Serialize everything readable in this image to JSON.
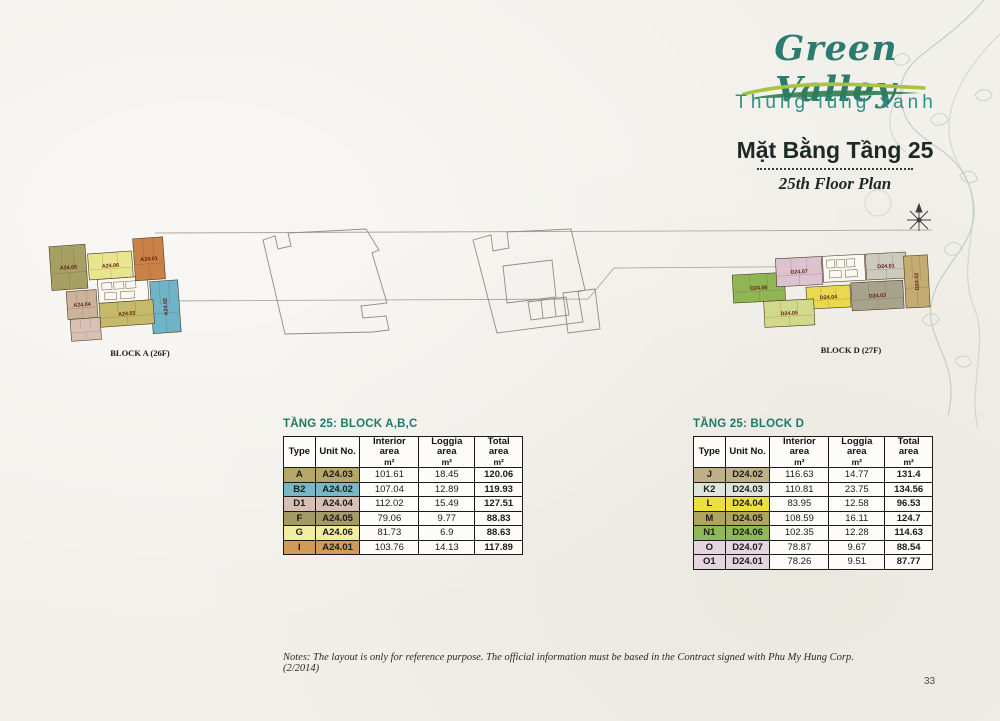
{
  "page": {
    "number": "33"
  },
  "header": {
    "logo_text": "Green Valley",
    "tagline": "Thung lũng xanh",
    "title_vi": "Mặt Bằng Tầng 25",
    "title_en": "25th Floor Plan"
  },
  "site_plan": {
    "block_a_label": "BLOCK A (26F)",
    "block_d_label": "BLOCK D (27F)",
    "block_a_units": [
      {
        "id": "A24.05",
        "color": "#a7a065"
      },
      {
        "id": "A24.06",
        "color": "#e9e48e"
      },
      {
        "id": "A24.01",
        "color": "#c98146"
      },
      {
        "id": "A24.04",
        "color": "#cbb49a"
      },
      {
        "id": "A24.02",
        "color": "#6fb4c8"
      },
      {
        "id": "A24.03",
        "color": "#c5b96a"
      },
      {
        "id": "",
        "color": "#d8c0b4"
      }
    ],
    "block_d_units": [
      {
        "id": "D24.06",
        "color": "#8fb554"
      },
      {
        "id": "D24.07",
        "color": "#dcc3cf"
      },
      {
        "id": "D24.01",
        "color": "#ccc9bd"
      },
      {
        "id": "D24.02",
        "color": "#c3ab72"
      },
      {
        "id": "D24.04",
        "color": "#ead94e"
      },
      {
        "id": "D24.03",
        "color": "#a8a48c"
      },
      {
        "id": "D24.05",
        "color": "#d3d98a"
      }
    ]
  },
  "tables": [
    {
      "title": "TẦNG 25: BLOCK A,B,C",
      "headers": [
        {
          "label": "Type"
        },
        {
          "label": "Unit No."
        },
        {
          "label": "Interior area",
          "unit": "m²"
        },
        {
          "label": "Loggia area",
          "unit": "m²"
        },
        {
          "label": "Total area",
          "unit": "m²"
        }
      ],
      "rows": [
        {
          "type": "A",
          "color": "#b5a76a",
          "unit": "A24.03",
          "interior": "101.61",
          "loggia": "18.45",
          "total": "120.06"
        },
        {
          "type": "B2",
          "color": "#79b7c6",
          "unit": "A24.02",
          "interior": "107.04",
          "loggia": "12.89",
          "total": "119.93"
        },
        {
          "type": "D1",
          "color": "#d7bfb3",
          "unit": "A24.04",
          "interior": "112.02",
          "loggia": "15.49",
          "total": "127.51"
        },
        {
          "type": "F",
          "color": "#a49a66",
          "unit": "A24.05",
          "interior": "79.06",
          "loggia": "9.77",
          "total": "88.83"
        },
        {
          "type": "G",
          "color": "#f2eda0",
          "unit": "A24.06",
          "interior": "81.73",
          "loggia": "6.9",
          "total": "88.63"
        },
        {
          "type": "I",
          "color": "#d09a58",
          "unit": "A24.01",
          "interior": "103.76",
          "loggia": "14.13",
          "total": "117.89"
        }
      ]
    },
    {
      "title": "TẦNG 25: BLOCK D",
      "headers": [
        {
          "label": "Type"
        },
        {
          "label": "Unit No."
        },
        {
          "label": "Interior area",
          "unit": "m²"
        },
        {
          "label": "Loggia area",
          "unit": "m²"
        },
        {
          "label": "Total area",
          "unit": "m²"
        }
      ],
      "rows": [
        {
          "type": "J",
          "color": "#c0b087",
          "unit": "D24.02",
          "interior": "116.63",
          "loggia": "14.77",
          "total": "131.4"
        },
        {
          "type": "K2",
          "color": "#dfe5dc",
          "unit": "D24.03",
          "interior": "110.81",
          "loggia": "23.75",
          "total": "134.56"
        },
        {
          "type": "L",
          "color": "#ecdf3e",
          "unit": "D24.04",
          "interior": "83.95",
          "loggia": "12.58",
          "total": "96.53"
        },
        {
          "type": "M",
          "color": "#b0a55e",
          "unit": "D24.05",
          "interior": "108.59",
          "loggia": "16.11",
          "total": "124.7"
        },
        {
          "type": "N1",
          "color": "#8eb958",
          "unit": "D24.06",
          "interior": "102.35",
          "loggia": "12.28",
          "total": "114.63"
        },
        {
          "type": "O",
          "color": "#e5d5de",
          "unit": "D24.07",
          "interior": "78.87",
          "loggia": "9.67",
          "total": "88.54"
        },
        {
          "type": "O1",
          "color": "#e5d5de",
          "unit": "D24.01",
          "interior": "78.26",
          "loggia": "9.51",
          "total": "87.77"
        }
      ]
    }
  ],
  "note": "Notes: The layout is only for reference purpose. The official information must be based in the Contract signed with Phu My Hung Corp. (2/2014)"
}
